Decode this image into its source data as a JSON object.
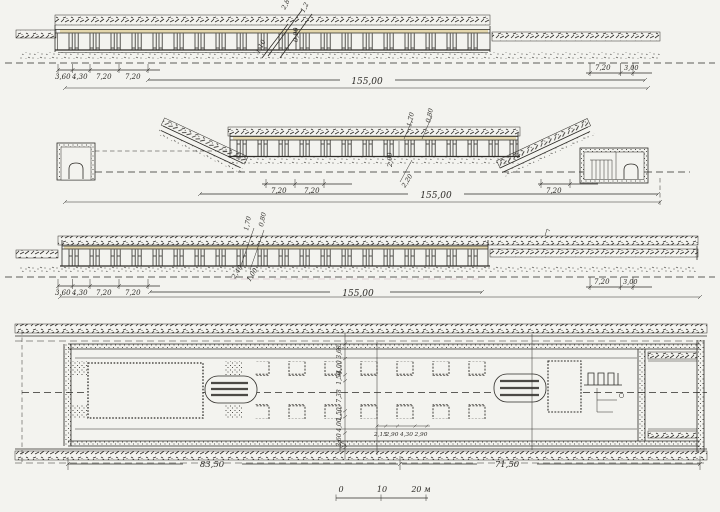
{
  "colors": {
    "paper": "#f3f3ef",
    "ink": "#2e2c28",
    "roof_tint": "#d9c37e",
    "pink_tint": "#a8688c"
  },
  "s1": {
    "left": [
      "3,60",
      "4,30",
      "7,20",
      "7,20"
    ],
    "total": "155,00",
    "right": [
      "7,20",
      "3,00"
    ],
    "callouts": [
      "2,8",
      "1,2",
      "0,90",
      "1,10"
    ]
  },
  "s2": {
    "callouts": [
      "1,70",
      "0,80",
      "2,00",
      "2,20"
    ],
    "left": [
      "7,20",
      "7,20"
    ],
    "right": [
      "7,20"
    ],
    "total": "155,00"
  },
  "s3": {
    "left": [
      "3,60",
      "4,30",
      "7,20",
      "7,20"
    ],
    "total": "155,00",
    "right": [
      "7,20",
      "3,00"
    ],
    "callouts": [
      "1,70",
      "0,80",
      "2,40",
      "1,00"
    ]
  },
  "plan": {
    "cross": [
      "3,60",
      "4,00",
      "1,50",
      "7,38",
      "1,50",
      "4,00",
      "3,60"
    ],
    "detail": [
      "2,15",
      "2,90",
      "4,30",
      "2,90"
    ],
    "lengths": [
      "83,50",
      "71,50"
    ]
  },
  "scale": {
    "t0": "0",
    "t1": "10",
    "t2": "20 м"
  }
}
